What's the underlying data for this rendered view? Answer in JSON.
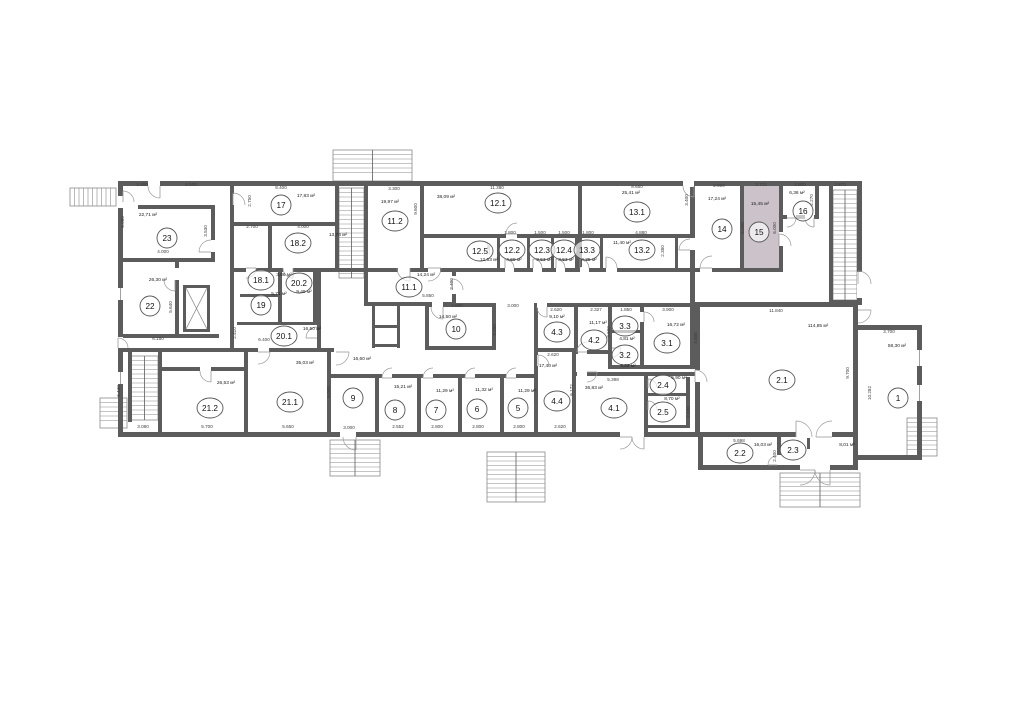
{
  "colors": {
    "highlight": "#cbc2ca",
    "wall": "#5c5c5c",
    "thin": "#8a8a8a",
    "door": "#9a9a9a",
    "text": "#222222"
  },
  "highlighted_room": "15",
  "rooms": [
    {
      "n": "23",
      "a": "22,71 м²",
      "x": 167,
      "y": 238,
      "ax": 148,
      "ay": 216
    },
    {
      "n": "17",
      "a": "17,83 м²",
      "x": 281,
      "y": 205,
      "ax": 306,
      "ay": 197
    },
    {
      "n": "18.2",
      "a": "13,74 м²",
      "x": 298,
      "y": 243,
      "ax": 338,
      "ay": 236
    },
    {
      "n": "18.1",
      "a": "3,86 м²",
      "x": 261,
      "y": 280,
      "ax": 284,
      "ay": 276
    },
    {
      "n": "19",
      "a": "5,71 м²",
      "x": 261,
      "y": 305,
      "ax": 279,
      "ay": 295
    },
    {
      "n": "20.2",
      "a": "9,49 м²",
      "x": 299,
      "y": 283,
      "ax": 304,
      "ay": 293
    },
    {
      "n": "20.1",
      "a": "16,50 м²",
      "x": 284,
      "y": 336,
      "ax": 312,
      "ay": 330
    },
    {
      "n": "22",
      "a": "26,30 м²",
      "x": 150,
      "y": 306,
      "ax": 158,
      "ay": 281
    },
    {
      "n": "21.2",
      "a": "26,53 м²",
      "x": 210,
      "y": 408,
      "ax": 226,
      "ay": 384
    },
    {
      "n": "21.1",
      "a": "35,03 м²",
      "x": 290,
      "y": 402,
      "ax": 305,
      "ay": 364
    },
    {
      "n": "9",
      "a": "16,60 м²",
      "x": 353,
      "y": 398,
      "ax": 362,
      "ay": 360
    },
    {
      "n": "8",
      "a": "15,21 м²",
      "x": 395,
      "y": 410,
      "ax": 403,
      "ay": 388
    },
    {
      "n": "7",
      "a": "11,29 м²",
      "x": 436,
      "y": 410,
      "ax": 445,
      "ay": 392
    },
    {
      "n": "6",
      "a": "11,32 м²",
      "x": 477,
      "y": 409,
      "ax": 484,
      "ay": 391
    },
    {
      "n": "5",
      "a": "11,29 м²",
      "x": 518,
      "y": 408,
      "ax": 527,
      "ay": 392
    },
    {
      "n": "4.4",
      "a": "17,40 м²",
      "x": 557,
      "y": 401,
      "ax": 548,
      "ay": 367
    },
    {
      "n": "4.1",
      "a": "36,83 м²",
      "x": 614,
      "y": 408,
      "ax": 594,
      "ay": 389
    },
    {
      "n": "4.3",
      "a": "9,10 м²",
      "x": 557,
      "y": 332,
      "ax": 557,
      "ay": 318
    },
    {
      "n": "4.2",
      "a": "11,17 м²",
      "x": 594,
      "y": 340,
      "ax": 598,
      "ay": 324
    },
    {
      "n": "3.3",
      "a": "4,81 м²",
      "x": 625,
      "y": 326,
      "ax": 627,
      "ay": 340
    },
    {
      "n": "3.2",
      "a": "3,02 м²",
      "x": 625,
      "y": 355,
      "ax": 628,
      "ay": 367
    },
    {
      "n": "3.1",
      "a": "16,72 м²",
      "x": 667,
      "y": 343,
      "ax": 676,
      "ay": 326
    },
    {
      "n": "2.4",
      "a": "5,90 м²",
      "x": 663,
      "y": 385,
      "ax": 679,
      "ay": 379
    },
    {
      "n": "2.5",
      "a": "8,70 м²",
      "x": 663,
      "y": 412,
      "ax": 672,
      "ay": 400
    },
    {
      "n": "2.1",
      "a": "114,85 м²",
      "x": 782,
      "y": 380,
      "ax": 818,
      "ay": 327
    },
    {
      "n": "1",
      "a": "58,30 м²",
      "x": 898,
      "y": 398,
      "ax": 897,
      "ay": 347
    },
    {
      "n": "2.2",
      "a": "16,03 м²",
      "x": 740,
      "y": 453,
      "ax": 763,
      "ay": 446
    },
    {
      "n": "2.3",
      "a": "8,01 м²",
      "x": 793,
      "y": 450,
      "ax": 847,
      "ay": 446
    },
    {
      "n": "11.2",
      "a": "19,97 м²",
      "x": 395,
      "y": 221,
      "ax": 390,
      "ay": 203
    },
    {
      "n": "11.1",
      "a": "14,24 м²",
      "x": 409,
      "y": 287,
      "ax": 426,
      "ay": 276
    },
    {
      "n": "10",
      "a": "14,50 м²",
      "x": 456,
      "y": 329,
      "ax": 448,
      "ay": 318
    },
    {
      "n": "12.1",
      "a": "38,09 м²",
      "x": 498,
      "y": 203,
      "ax": 446,
      "ay": 198
    },
    {
      "n": "12.5",
      "a": "12,53 м²",
      "x": 480,
      "y": 251,
      "ax": 489,
      "ay": 261
    },
    {
      "n": "12.2",
      "a": "4,69 м²",
      "x": 512,
      "y": 250,
      "ax": 514,
      "ay": 261
    },
    {
      "n": "12.3",
      "a": "3,53 м²",
      "x": 542,
      "y": 250,
      "ax": 544,
      "ay": 261
    },
    {
      "n": "12.4",
      "a": "3,53 м²",
      "x": 564,
      "y": 250,
      "ax": 566,
      "ay": 261
    },
    {
      "n": "13.3",
      "a": "4,35 м²",
      "x": 587,
      "y": 250,
      "ax": 589,
      "ay": 261
    },
    {
      "n": "13.2",
      "a": "11,40 м²",
      "x": 642,
      "y": 250,
      "ax": 622,
      "ay": 244
    },
    {
      "n": "13.1",
      "a": "25,41 м²",
      "x": 637,
      "y": 212,
      "ax": 631,
      "ay": 194
    },
    {
      "n": "14",
      "a": "17,24 м²",
      "x": 722,
      "y": 229,
      "ax": 717,
      "ay": 200
    },
    {
      "n": "15",
      "a": "15,45 м²",
      "x": 759,
      "y": 232,
      "ax": 760,
      "ay": 205
    },
    {
      "n": "16",
      "a": "6,36 м²",
      "x": 803,
      "y": 211,
      "ax": 797,
      "ay": 194
    }
  ],
  "dims": [
    {
      "t": "1.500",
      "x": 142,
      "y": 186
    },
    {
      "t": "8.500",
      "x": 191,
      "y": 186
    },
    {
      "t": "8.400",
      "x": 281,
      "y": 189
    },
    {
      "t": "3.300",
      "x": 394,
      "y": 190
    },
    {
      "t": "11.380",
      "x": 497,
      "y": 189
    },
    {
      "t": "8.650",
      "x": 637,
      "y": 188
    },
    {
      "t": "2.900",
      "x": 719,
      "y": 187
    },
    {
      "t": "2.722",
      "x": 761,
      "y": 186
    },
    {
      "t": "2.800",
      "x": 800,
      "y": 186
    },
    {
      "t": "2.870",
      "x": 840,
      "y": 186
    },
    {
      "t": "2.750",
      "x": 251,
      "y": 201,
      "v": 1
    },
    {
      "t": "6.080",
      "x": 124,
      "y": 222,
      "v": 1
    },
    {
      "t": "3.530",
      "x": 207,
      "y": 231,
      "v": 1
    },
    {
      "t": "4.000",
      "x": 163,
      "y": 253
    },
    {
      "t": "2.700",
      "x": 252,
      "y": 228
    },
    {
      "t": "4.000",
      "x": 303,
      "y": 228
    },
    {
      "t": "6.150",
      "x": 158,
      "y": 340
    },
    {
      "t": "5.640",
      "x": 172,
      "y": 307,
      "v": 1
    },
    {
      "t": "9.600",
      "x": 417,
      "y": 209,
      "v": 1
    },
    {
      "t": "2.350",
      "x": 490,
      "y": 249,
      "v": 1
    },
    {
      "t": "1.800",
      "x": 510,
      "y": 234
    },
    {
      "t": "1.500",
      "x": 540,
      "y": 234
    },
    {
      "t": "1.500",
      "x": 564,
      "y": 234
    },
    {
      "t": "1.800",
      "x": 588,
      "y": 234
    },
    {
      "t": "4.880",
      "x": 641,
      "y": 234
    },
    {
      "t": "2.380",
      "x": 664,
      "y": 251,
      "v": 1
    },
    {
      "t": "3.400",
      "x": 688,
      "y": 200,
      "v": 1
    },
    {
      "t": "6.000",
      "x": 744,
      "y": 228,
      "v": 1
    },
    {
      "t": "6.000",
      "x": 776,
      "y": 228,
      "v": 1
    },
    {
      "t": "2.270",
      "x": 813,
      "y": 200,
      "v": 1
    },
    {
      "t": "5.850",
      "x": 428,
      "y": 297
    },
    {
      "t": "2.400",
      "x": 453,
      "y": 284,
      "v": 1
    },
    {
      "t": "4.500",
      "x": 457,
      "y": 307
    },
    {
      "t": "3.000",
      "x": 513,
      "y": 307
    },
    {
      "t": "3.200",
      "x": 496,
      "y": 330,
      "v": 1
    },
    {
      "t": "6.400",
      "x": 264,
      "y": 341
    },
    {
      "t": "2.410",
      "x": 236,
      "y": 333,
      "v": 1
    },
    {
      "t": "2.620",
      "x": 556,
      "y": 311
    },
    {
      "t": "2.327",
      "x": 596,
      "y": 311
    },
    {
      "t": "1.850",
      "x": 626,
      "y": 311
    },
    {
      "t": "3.900",
      "x": 668,
      "y": 311
    },
    {
      "t": "3.600",
      "x": 610,
      "y": 332,
      "v": 1
    },
    {
      "t": "4.800",
      "x": 697,
      "y": 338,
      "v": 1
    },
    {
      "t": "2.620",
      "x": 553,
      "y": 356
    },
    {
      "t": "6.172",
      "x": 573,
      "y": 390,
      "v": 1
    },
    {
      "t": "5.398",
      "x": 613,
      "y": 381
    },
    {
      "t": "11.840",
      "x": 776,
      "y": 312
    },
    {
      "t": "3.700",
      "x": 889,
      "y": 333
    },
    {
      "t": "9.700",
      "x": 849,
      "y": 373,
      "v": 1
    },
    {
      "t": "10.282",
      "x": 871,
      "y": 393,
      "v": 1
    },
    {
      "t": "2.070",
      "x": 690,
      "y": 412,
      "v": 1
    },
    {
      "t": "3.080",
      "x": 143,
      "y": 428
    },
    {
      "t": "5.700",
      "x": 207,
      "y": 428
    },
    {
      "t": "5.650",
      "x": 288,
      "y": 428
    },
    {
      "t": "3.000",
      "x": 349,
      "y": 429
    },
    {
      "t": "2.552",
      "x": 398,
      "y": 428
    },
    {
      "t": "2.800",
      "x": 437,
      "y": 428
    },
    {
      "t": "2.800",
      "x": 478,
      "y": 428
    },
    {
      "t": "2.800",
      "x": 519,
      "y": 428
    },
    {
      "t": "2.620",
      "x": 560,
      "y": 428
    },
    {
      "t": "5.698",
      "x": 739,
      "y": 442
    },
    {
      "t": "2.400",
      "x": 776,
      "y": 456,
      "v": 1
    },
    {
      "t": "6.440",
      "x": 120,
      "y": 391,
      "v": 1
    },
    {
      "t": "6.000",
      "x": 330,
      "y": 392,
      "v": 1
    }
  ]
}
